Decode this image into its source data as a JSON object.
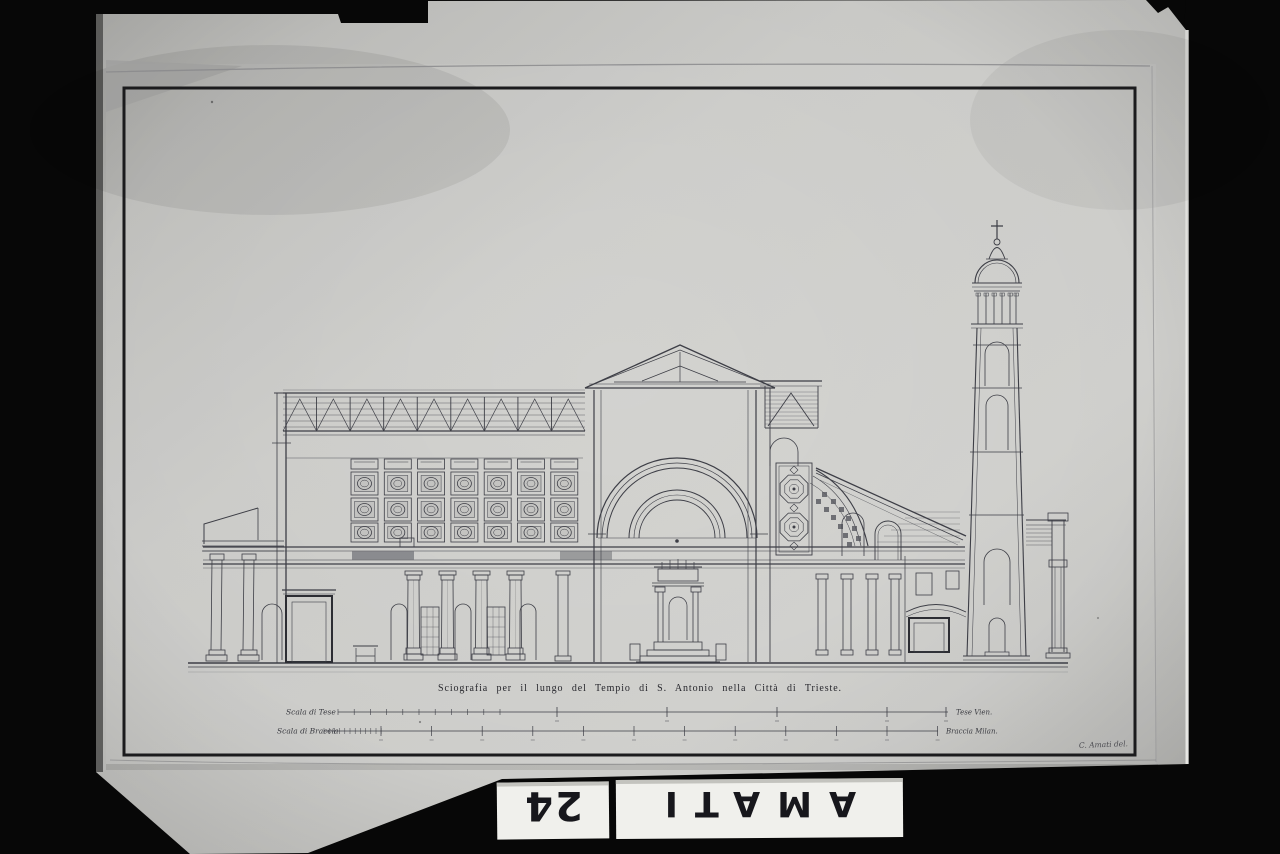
{
  "photo": {
    "background_color": "#070707",
    "paper_color": "#cacac7",
    "ink_color": "#3d3e46",
    "card_color": "#f0f0ec"
  },
  "drawing": {
    "caption": "Sciografia per il lungo del Tempio di S. Antonio nella Città di Trieste.",
    "signature": "C. Amati del.",
    "scale_bars": [
      {
        "label": "Scala di Tese",
        "unit_note": "Tese Vien."
      },
      {
        "label": "Scala di Braccia",
        "unit_note": "Braccia Milan."
      }
    ]
  },
  "archive_cards": {
    "number": "24",
    "name": "AMATI"
  }
}
